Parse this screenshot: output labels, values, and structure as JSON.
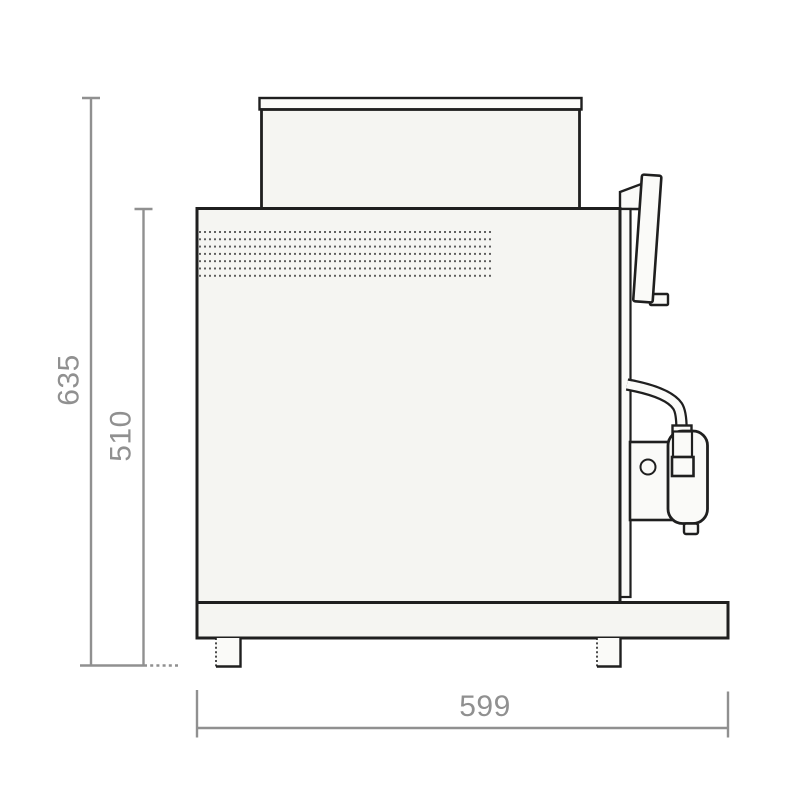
{
  "diagram": {
    "labels": {
      "overall_height": "635",
      "body_height": "510",
      "depth": "599"
    },
    "colors": {
      "background": "#ffffff",
      "outline": "#1f1f1f",
      "panel_fill": "#f5f5f2",
      "panel_fill_light": "#fafaf8",
      "dimension": "#909090",
      "vent_dot": "#5a5a5a"
    }
  }
}
